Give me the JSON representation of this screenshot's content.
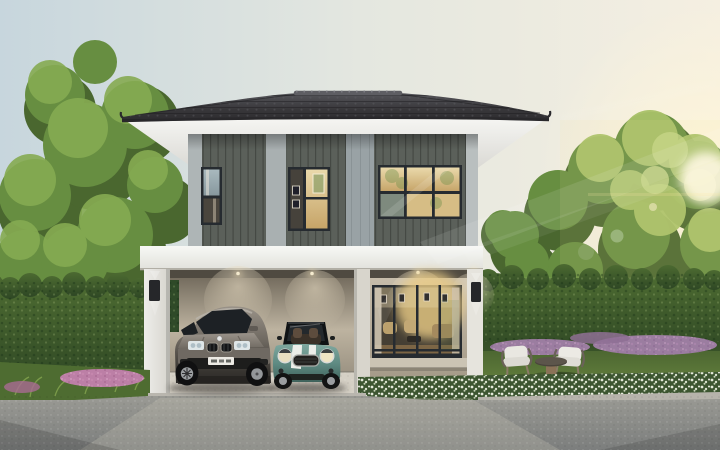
{
  "scene": {
    "caption": "Daytime exterior rendering of a modern two-storey detached house with a dark hip roof, grey-green vertical siding upstairs, a white-trimmed carport sheltering a grey SUV and a teal convertible with white bonnet stripes, a glazed living-room door with a warm lit interior, flanked by tall clipped hedges, mature trees, lawn, purple and white flower borders, and two white garden chairs with a small table at the right. Sunlight flares from the top right corner.",
    "license_plate": {
      "style": "white plate, characters not legible"
    },
    "lighting": "late afternoon sun from upper right, warm interior lights on"
  },
  "palette": {
    "sky_left": "#c7d6dd",
    "sky_mid": "#e4e7e0",
    "sky_right": "#f5efe1",
    "sun_glow": "#fff6d8",
    "roof_top": "#55555a",
    "roof_dark": "#2b2a2d",
    "fascia": "#f6f6f3",
    "soffit_deep": "#d8d7d2",
    "siding_dark": "#5b605a",
    "siding_shadow": "#454a45",
    "band_light": "#aeb5b6",
    "panel_gray": "#99a2a5",
    "floor_band": "#f1f2ef",
    "pillar_white": "#eeedea",
    "pillar_right": "#e6e4dd",
    "wall_beige": "#b4aa98",
    "carport_wall": "#8d8576",
    "carport_wall_light": "#bdb3a0",
    "window_frame": "#262b30",
    "glass_warm": "#ead9ab",
    "glass_amber": "#c6a468",
    "glass_sky": "#a9b9be",
    "glass_dark": "#4a453d",
    "door_glow": "#e9cb85",
    "hedge_top": "#4c6a31",
    "hedge_dark": "#2e4724",
    "tree_dark": "#4a672f",
    "tree_mid": "#678e41",
    "tree_light": "#86ab52",
    "tree_sunlit": "#a8c168",
    "grass_light": "#6d8a42",
    "grass_dark": "#46602e",
    "flower_white": "#edf1e3",
    "flower_purple": "#9b7da0",
    "flower_pink": "#bc7fa6",
    "terrazzo": "#d5d0c5",
    "step_stone": "#b9b6ae",
    "curb": "#b6b3ab",
    "road_light": "#9a9a94",
    "road_dark": "#7c7e7d",
    "suv_body": "#6e6860",
    "suv_body_light": "#999288",
    "suv_body_dark": "#373430",
    "mini_body": "#5f8b83",
    "mini_body_light": "#7fa89f",
    "mini_body_dark": "#3f625b",
    "stripe_white": "#eceee9",
    "seat_brown": "#5d4c3d",
    "lamp_dark": "#26272a",
    "light_warm": "#ffe9b0"
  }
}
